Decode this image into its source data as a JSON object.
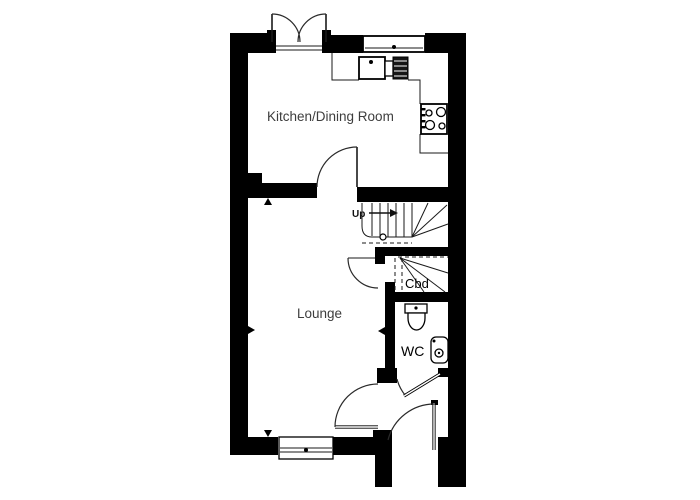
{
  "plan": {
    "rooms": {
      "kitchen_label": "Kitchen/Dining Room",
      "lounge_label": "Lounge",
      "wc_label": "WC",
      "cupboard_label": "Cbd"
    },
    "stairs": {
      "up_label": "Up"
    },
    "colors": {
      "wall": "#000000",
      "label_text": "#3d3d3d",
      "line": "#1a1a1a"
    }
  }
}
